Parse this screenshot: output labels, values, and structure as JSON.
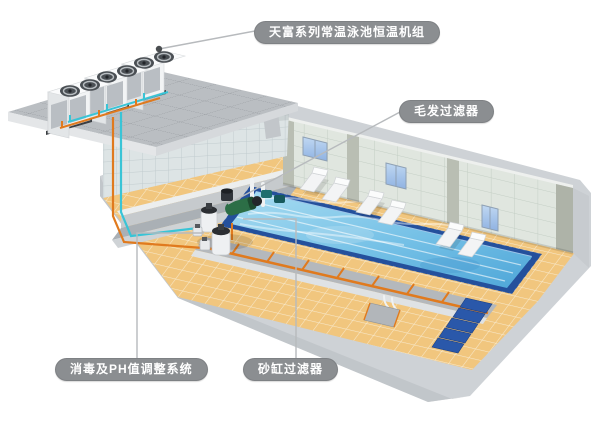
{
  "labels": {
    "heat_pump": {
      "text": "天富系列常温泳池恒温机组"
    },
    "hair_filter": {
      "text": "毛发过滤器"
    },
    "disinfection": {
      "text": "消毒及PH值调整系统"
    },
    "sand_filter": {
      "text": "砂缸过滤器"
    }
  },
  "scene": {
    "heat_pump_unit_count": 3,
    "lounger_pair_count": 3,
    "window_count": 3,
    "pool_step_count": 5
  },
  "colors": {
    "label_pill": "#8b8e91",
    "label_text": "#ffffff",
    "leader_line": "#b7babd",
    "pipe_supply_cyan": "#39c4d6",
    "pipe_return_orange": "#e07a1e",
    "pool_water": "#7fc6e8",
    "pool_rim": "#24509c",
    "deck_tile": "#f1c67e",
    "wall_tile": "#dfe5de",
    "concrete_base": "#ced2d6"
  }
}
